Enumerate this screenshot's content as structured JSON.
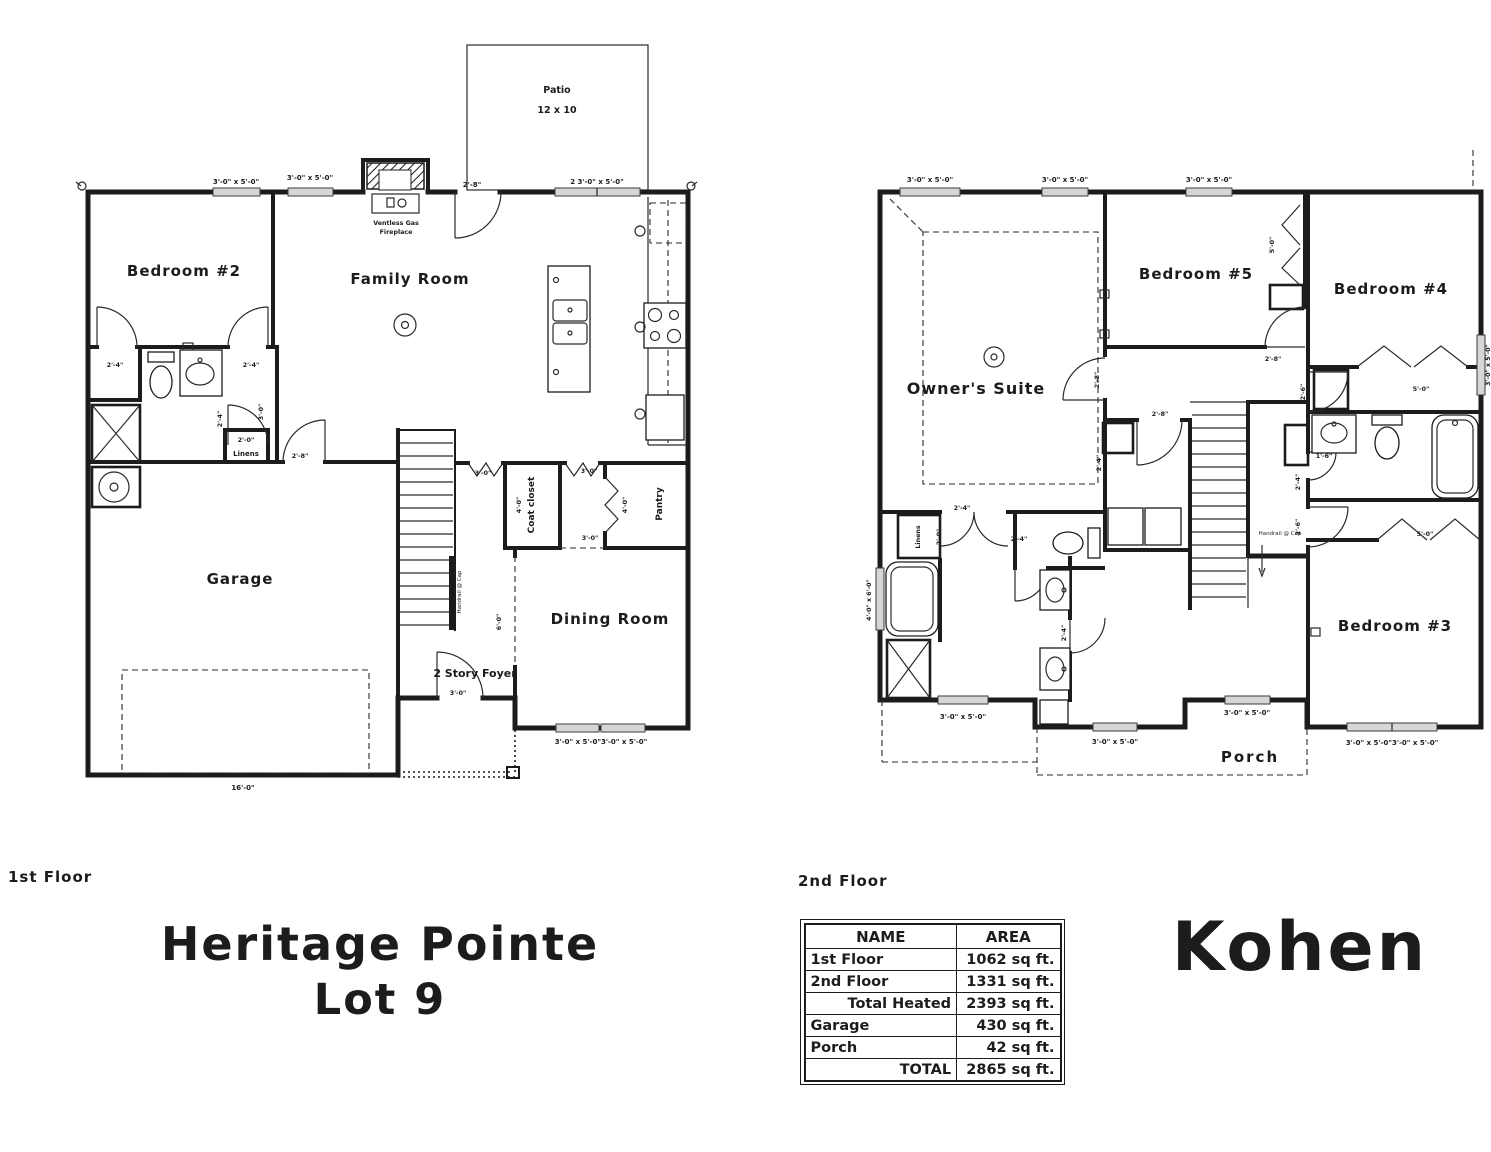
{
  "sheet": {
    "background": "#ffffff",
    "ink": "#1c1c1c"
  },
  "floor1": {
    "label": "1st Floor",
    "rooms": {
      "bedroom2": "Bedroom #2",
      "family_room": "Family Room",
      "garage": "Garage",
      "dining_room": "Dining Room",
      "foyer": "2 Story Foyer",
      "coat_closet": "Coat closet",
      "pantry": "Pantry",
      "linens": "Linens",
      "patio": "Patio",
      "patio_size": "12 x 10",
      "fireplace_line1": "Ventless Gas",
      "fireplace_line2": "Fireplace"
    }
  },
  "floor2": {
    "label": "2nd Floor",
    "rooms": {
      "owners_suite": "Owner's Suite",
      "bedroom3": "Bedroom #3",
      "bedroom4": "Bedroom #4",
      "bedroom5": "Bedroom #5",
      "porch": "Porch",
      "linens": "Linens"
    }
  },
  "dims": {
    "win_3x5": "3'-0\" x 5'-0\"",
    "win_3x5_pair": "3'-0\" x 5'-0\"3'-0\" x 5'-0\"",
    "win_2_3x5": "2 3'-0\" x 5'-0\"",
    "tub_4x6": "4'-0\" x 6'-0\"",
    "d1_6": "1'-6\"",
    "d2_0": "2'-0\"",
    "d2_4": "2'-4\"",
    "d2_6": "2'-6\"",
    "d2_8": "2'-8\"",
    "d3_0": "3'-0\"",
    "d4_0": "4'-0\"",
    "d5_0": "5'-0\"",
    "d6_0": "6'-0\"",
    "d16_0": "16'-0\"",
    "handrail": "Handrail @ Cap"
  },
  "titles": {
    "community": "Heritage Pointe",
    "lot": "Lot 9",
    "plan_name": "Kohen"
  },
  "area_table": {
    "headers": [
      "NAME",
      "AREA"
    ],
    "rows": [
      {
        "name": "1st Floor",
        "area": "1062 sq ft."
      },
      {
        "name": "2nd Floor",
        "area": "1331 sq ft."
      },
      {
        "name": "Total Heated",
        "area": "2393 sq ft."
      },
      {
        "name": "Garage",
        "area": "430 sq ft."
      },
      {
        "name": "Porch",
        "area": "42 sq ft."
      },
      {
        "name": "TOTAL",
        "area": "2865 sq ft."
      }
    ]
  }
}
